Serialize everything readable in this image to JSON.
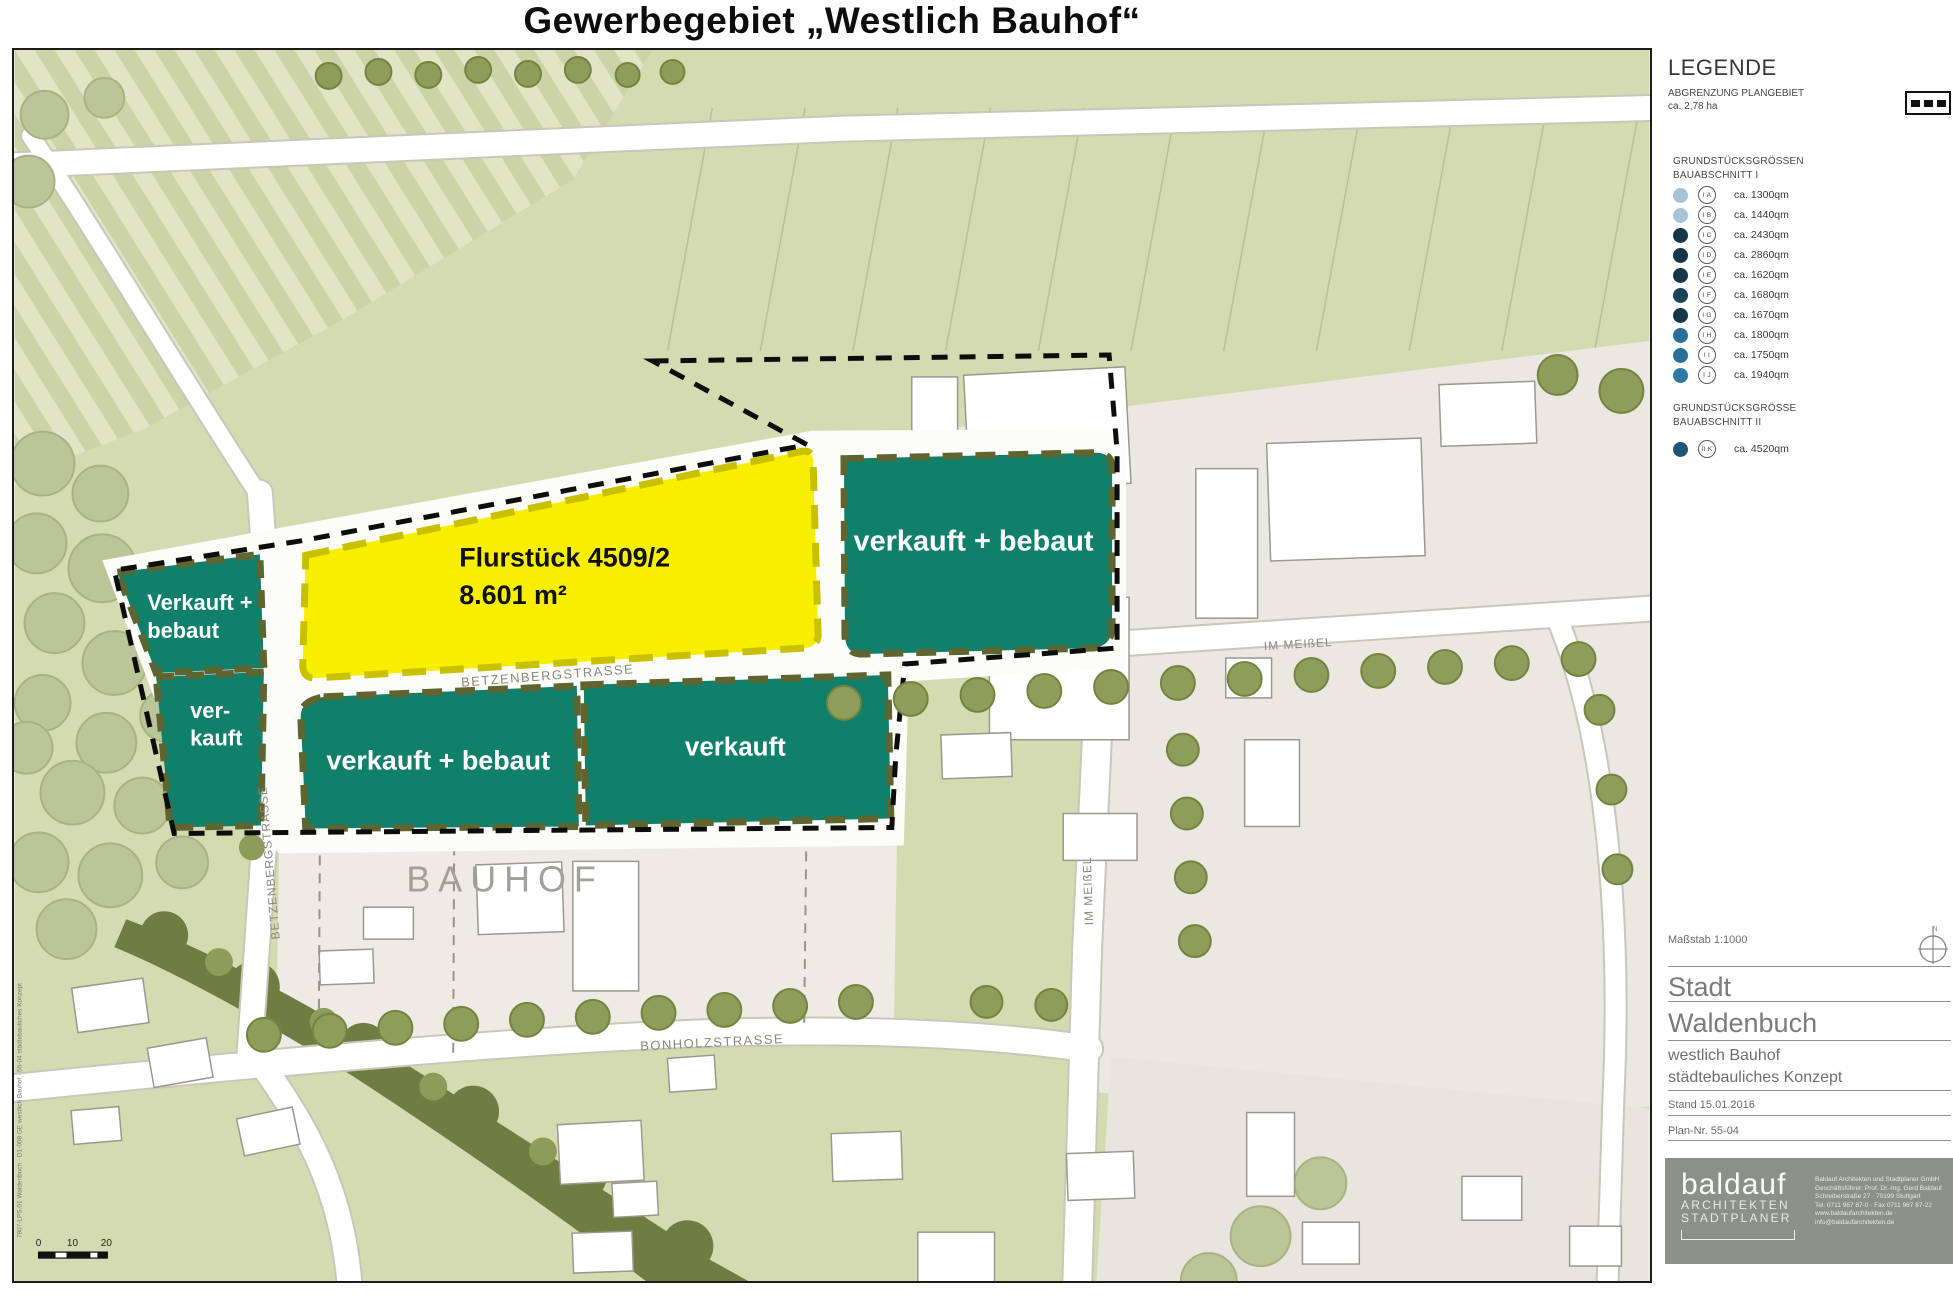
{
  "title": "Gewerbegebiet „Westlich Bauhof“",
  "map": {
    "parcel_labels": {
      "left_upper_l1": "Verkauft +",
      "left_upper_l2": "bebaut",
      "left_lower_l1": "ver-",
      "left_lower_l2": "kauft",
      "middle_left": "verkauft + bebaut",
      "middle_right": "verkauft",
      "right": "verkauft + bebaut",
      "flurstueck_l1": "Flurstück 4509/2",
      "flurstueck_l2": "8.601 m²"
    },
    "street_labels": {
      "betzenberg_h": "BETZENBERGSTRASSE",
      "betzenberg_v": "BETZENBERGSTRASSE",
      "im_meissel_h": "IM MEIßEL",
      "im_meissel_v": "IM MEIßEL",
      "bonholz": "BONHOLZSTRASSE",
      "bauhof": "BAUHOF"
    },
    "scalebar": {
      "t0": "0",
      "t10": "10",
      "t20": "20"
    },
    "plot_stamp": "7807-LPS.01 Waldenbuch · D1-008 GE westlich Bauhof · 55-04 städtebauliches Konzept",
    "colors": {
      "parcel_green": "#11806a",
      "parcel_green_border": "#5e6530",
      "parcel_yellow": "#f7ee00",
      "parcel_yellow_border": "#c9c000",
      "plan_boundary": "#0d0d0d"
    }
  },
  "legend": {
    "heading": "LEGENDE",
    "boundary_label_l1": "ABGRENZUNG PLANGEBIET",
    "boundary_label_l2": "ca. 2,78 ha",
    "section1_l1": "GRUNDSTÜCKSGRÖSSEN",
    "section1_l2": "BAUABSCHNITT I",
    "items1": [
      {
        "id": "I A",
        "area": "ca. 1300qm",
        "color": "#a6c4d6"
      },
      {
        "id": "I B",
        "area": "ca. 1440qm",
        "color": "#a6c4d6"
      },
      {
        "id": "I C",
        "area": "ca. 2430qm",
        "color": "#16374a"
      },
      {
        "id": "I D",
        "area": "ca. 2860qm",
        "color": "#16374a"
      },
      {
        "id": "I E",
        "area": "ca. 1620qm",
        "color": "#16374a"
      },
      {
        "id": "I F",
        "area": "ca. 1680qm",
        "color": "#1c4459"
      },
      {
        "id": "I G",
        "area": "ca. 1670qm",
        "color": "#16374a"
      },
      {
        "id": "I H",
        "area": "ca. 1800qm",
        "color": "#2a6f99"
      },
      {
        "id": "I I",
        "area": "ca. 1750qm",
        "color": "#2a6f99"
      },
      {
        "id": "I J",
        "area": "ca. 1940qm",
        "color": "#2f7aa5"
      }
    ],
    "section2_l1": "GRUNDSTÜCKSGRÖSSE",
    "section2_l2": "BAUABSCHNITT II",
    "items2": [
      {
        "id": "II K",
        "area": "ca. 4520qm",
        "color": "#1d5677"
      }
    ]
  },
  "titleblock": {
    "scale": "Maßstab 1:1000",
    "north": "N",
    "city_l1": "Stadt",
    "city_l2": "Waldenbuch",
    "project_l1": "westlich Bauhof",
    "project_l2": "städtebauliches Konzept",
    "stand": "Stand 15.01.2016",
    "plan_nr": "Plan-Nr. 55-04"
  },
  "firm": {
    "logo": "baldauf",
    "logo_l1": "ARCHITEKTEN",
    "logo_l2": "STADTPLANER",
    "info": [
      "Baldauf Architekten und Stadtplaner GmbH",
      "Geschäftsführer: Prof. Dr.-Ing. Gerd Baldauf",
      "Schreiberstraße 27 · 70199 Stuttgart",
      "Tel. 0711 967 87-0 · Fax 0711 967 87-22",
      "www.baldaufarchitekten.de · info@baldaufarchitekten.de"
    ]
  }
}
